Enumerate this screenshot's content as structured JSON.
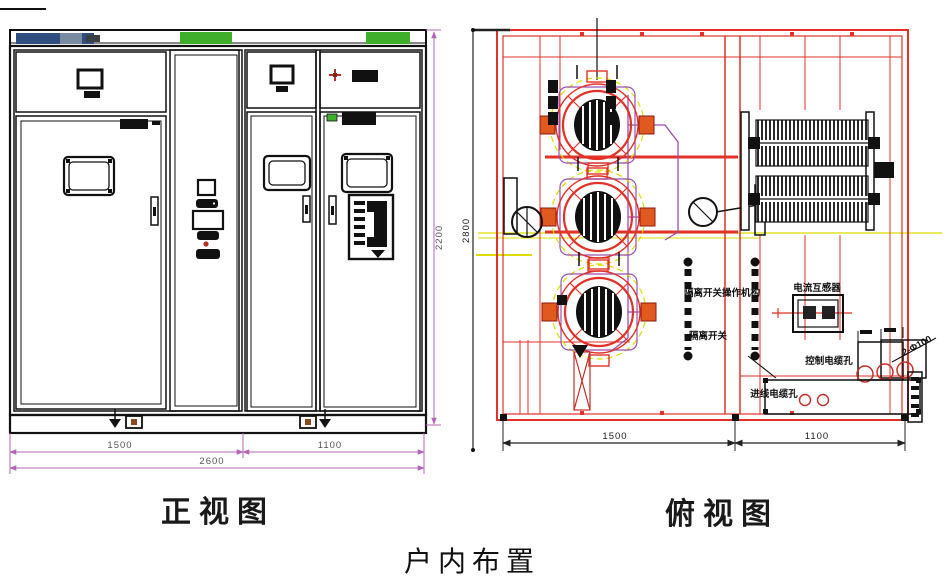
{
  "caption": "户内布置",
  "front_view": {
    "title": "正视图",
    "dims": {
      "left": "1500",
      "right": "1100",
      "total": "2600",
      "height": "2200"
    }
  },
  "top_view": {
    "title": "俯视图",
    "dims": {
      "left": "1500",
      "right": "1100",
      "depth": "2800"
    },
    "labels": {
      "current_transformer": "电流互感器",
      "operating_mechanism": "隔离开关操作机构",
      "disconnect_switch": "隔离开关",
      "control_cable_hole": "控制电缆孔",
      "incoming_cable_hole": "进线电缆孔",
      "hole_callout": "2-Φ100"
    }
  },
  "colors": {
    "frame_red": "#e03228",
    "dimension_magenta": "#b465b4",
    "accent_green": "#3fae2a",
    "nameplate_blue": "#2f4d7d",
    "aux_yellow": "#dcdc00",
    "aux_purple": "#9a4fb0",
    "ink": "#111111"
  }
}
